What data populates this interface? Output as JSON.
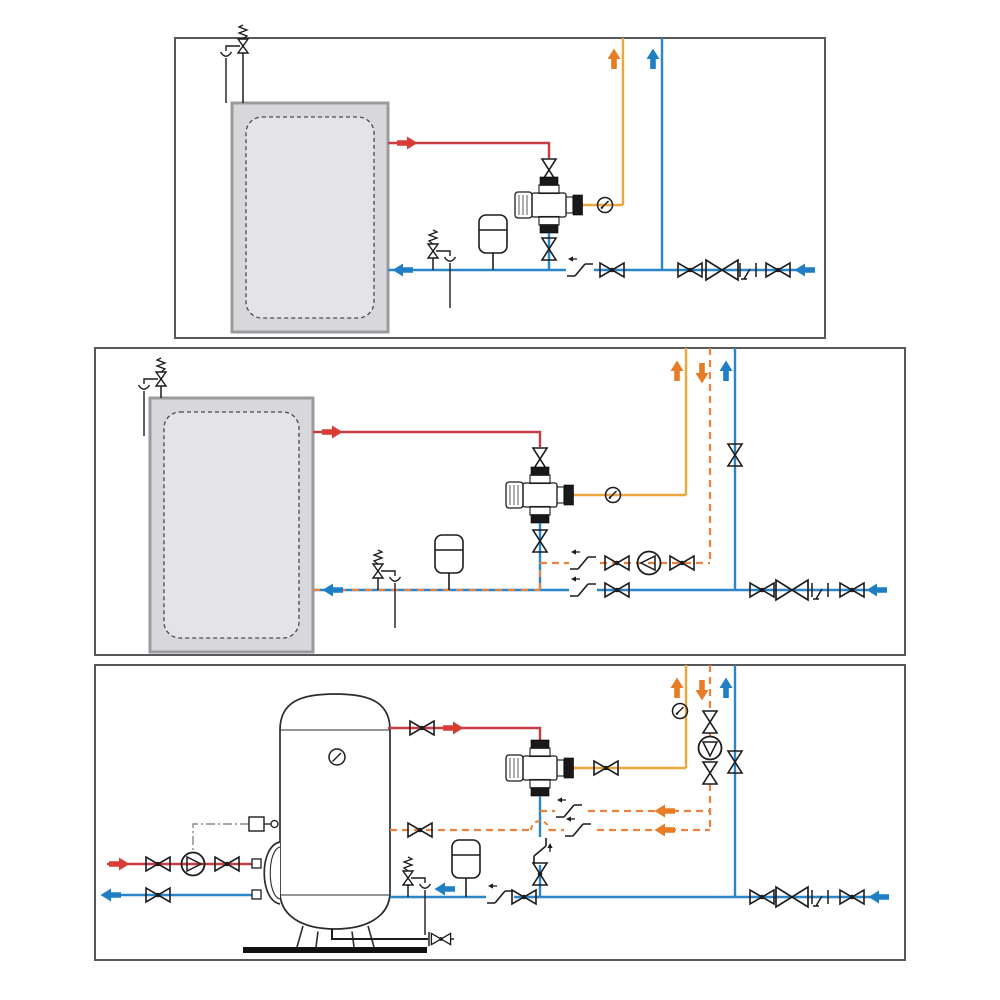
{
  "page": {
    "kind": "technical-diagram-sheet",
    "description": "Three hydraulic installation schematics of a thermostatic mixing valve on domestic hot water storage: top = basic installation, middle = installation with recirculation loop, bottom = vertical storage water heater with primary circuit, recirculation pump and dual return."
  },
  "colors": {
    "paper": "#ffffff",
    "border": "#58585a",
    "black": "#1c1c1e",
    "hot": "#c83d43",
    "hot_arrow": "#d93b35",
    "cold": "#2a86c6",
    "cold_arrow": "#1f7ec4",
    "mixed": "#eaa73e",
    "recirc": "#e8823d",
    "recirc_arrow": "#e87c26",
    "tank_fill": "#d8d8da",
    "tank_stroke": "#9b9b9f",
    "tank_inner": "#e4e4e6",
    "metal": "#c9c9cb",
    "metal_dark": "#19191b",
    "control": "#8a8a8a",
    "base_plate": "#111111"
  },
  "legend": {
    "mixing_valve": "thermostatic-mixing-valve",
    "ball_valve": "ball-shutoff-valve (bowtie with dot)",
    "shutoff_valve": "shutoff-valve (plain bowtie)",
    "big_valve": "pressure-reducing / backflow-preventer valve (large bowtie)",
    "check_valve": "non-return check valve (offset Z with flow arrow)",
    "pump": "circulation pump (circle with triangle)",
    "gauge": "temperature gauge (circle with needle)",
    "expansion_vessel": "expansion vessel (rounded rectangle with diaphragm line)",
    "safety_group": "safety relief valve with spring, tundish funnel and drain",
    "test_port": "test / drain port",
    "flow_arrow": "flow-direction block arrow"
  },
  "flows": {
    "hot": "red = hot water from storage",
    "cold": "blue = cold water supply",
    "mixed": "solid orange = mixed water to fixtures",
    "recirc": "dashed orange = DHW recirculation return",
    "control": "dash-dot gray = thermostat control line"
  },
  "panels": [
    {
      "id": "panel-1",
      "name": "basic installation",
      "components": [
        "storage-tank",
        "tank-safety-relief-group",
        "shutoff-valve-hot",
        "mixing-valve",
        "temperature-gauge",
        "shutoff-valve-cold-inlet",
        "line-safety-relief-group",
        "expansion-vessel",
        "check-valve",
        "ball-valve",
        "ball-valve",
        "big-valve",
        "test-port",
        "ball-valve"
      ],
      "arrows": [
        "mixed-up",
        "cold-up",
        "hot-right",
        "cold-left",
        "cold-inlet-left"
      ]
    },
    {
      "id": "panel-2",
      "name": "installation with recirculation",
      "components": [
        "storage-tank",
        "tank-safety-relief-group",
        "shutoff-valve-hot",
        "mixing-valve",
        "temperature-gauge",
        "shutoff-valve-riser",
        "shutoff-valve-cold-inlet",
        "recirc-check-valve",
        "recirc-ball-valve",
        "recirculation-pump",
        "recirc-ball-valve",
        "line-safety-relief-group",
        "expansion-vessel",
        "check-valve",
        "ball-valve",
        "ball-valve",
        "big-valve",
        "test-port",
        "ball-valve"
      ],
      "arrows": [
        "mixed-up",
        "recirc-down",
        "cold-up",
        "hot-right",
        "cold-left",
        "cold-inlet-left"
      ]
    },
    {
      "id": "panel-3",
      "name": "vertical storage heater with primary circuit and dual recirculation return",
      "components": [
        "vertical-storage-heater",
        "tank-thermometer",
        "flange-heat-exchanger",
        "thermostat-aquastat",
        "primary-pump",
        "primary-ball-valves",
        "hot-outlet-ball-valve",
        "mixing-valve",
        "mixed-outlet-ball-valve",
        "temperature-gauge",
        "recirc-shutoff-valves",
        "recirculation-pump",
        "riser-shutoff-valve",
        "recirc-check-valves",
        "recirc-ball-valve-to-tank",
        "cold-check-valve",
        "cold-ball-valve",
        "line-safety-relief-group",
        "expansion-vessel",
        "check-valve",
        "ball-valve",
        "ball-valve",
        "big-valve",
        "test-port",
        "ball-valve",
        "tank-drain-valve"
      ],
      "arrows": [
        "mixed-up",
        "recirc-down",
        "cold-up",
        "hot-right",
        "primary-hot-right",
        "primary-cold-left",
        "cold-left",
        "recirc-left",
        "recirc-left",
        "cold-inlet-left"
      ]
    }
  ]
}
